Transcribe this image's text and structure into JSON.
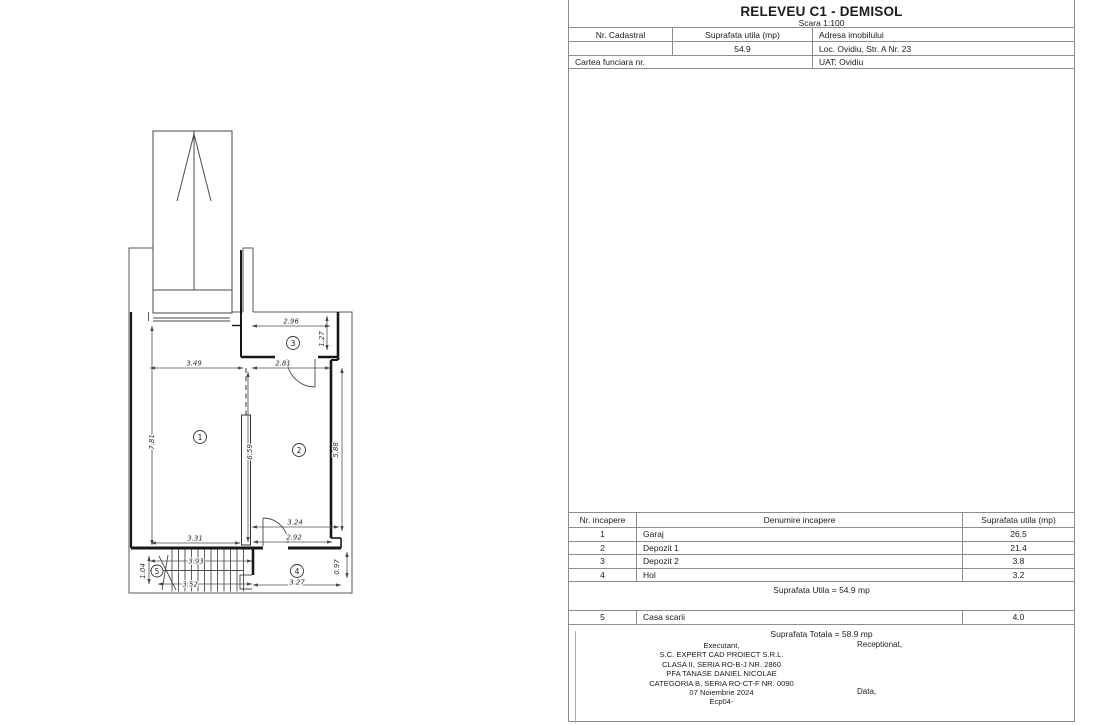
{
  "header": {
    "title": "RELEVEU C1 - DEMISOL",
    "scale": "Scara 1:100",
    "nr_cadastral_label": "Nr. Cadastral",
    "suprafata_label": "Suprafata utila (mp)",
    "adresa_label": "Adresa imobilului",
    "suprafata_value": "54.9",
    "adresa_value": "Loc. Ovidiu, Str. A Nr. 23",
    "cartea_funciara_label": "Cartea funciara nr.",
    "uat_value": "UAT: Ovidiu"
  },
  "rooms_table": {
    "headers": [
      "Nr. incapere",
      "Denumire incapere",
      "Suprafata utila (mp)"
    ],
    "rows": [
      {
        "nr": "1",
        "name": "Garaj",
        "area": "26.5"
      },
      {
        "nr": "2",
        "name": "Depozit 1",
        "area": "21.4"
      },
      {
        "nr": "3",
        "name": "Depozit 2",
        "area": "3.8"
      },
      {
        "nr": "4",
        "name": "Hol",
        "area": "3.2"
      }
    ],
    "suprafata_utila": "Suprafata Utila = 54.9 mp",
    "extra_row": {
      "nr": "5",
      "name": "Casa scarii",
      "area": "4.0"
    },
    "suprafata_totala": "Suprafata Totala = 58.9 mp"
  },
  "signature": {
    "executant_lines": [
      "Executant,",
      "S.C. EXPERT CAD PROIECT S.R.L.",
      "CLASA II, SERIA RO-B-J NR. 2860",
      "PFA TANASE DANIEL NICOLAE",
      "CATEGORIA B, SERIA RO-CT-F NR. 0090",
      "07 Noiembrie 2024",
      "Ecp04-"
    ],
    "receptionat": "Receptionat,",
    "data": "Data,"
  },
  "plan": {
    "rooms": {
      "r1": "1",
      "r2": "2",
      "r3": "3",
      "r4": "4",
      "r5": "5"
    },
    "dims": {
      "d349": "3.49",
      "d281": "2.81",
      "d296": "2.96",
      "d127": "1.27",
      "d781": "7.81",
      "d659": "6.59",
      "d588": "5.88",
      "d331": "3.31",
      "d324": "3.24",
      "d292": "2.92",
      "d393": "3.93",
      "d352": "3.52",
      "d104": "1.04",
      "d327": "3.27",
      "d097": "0.97"
    }
  }
}
